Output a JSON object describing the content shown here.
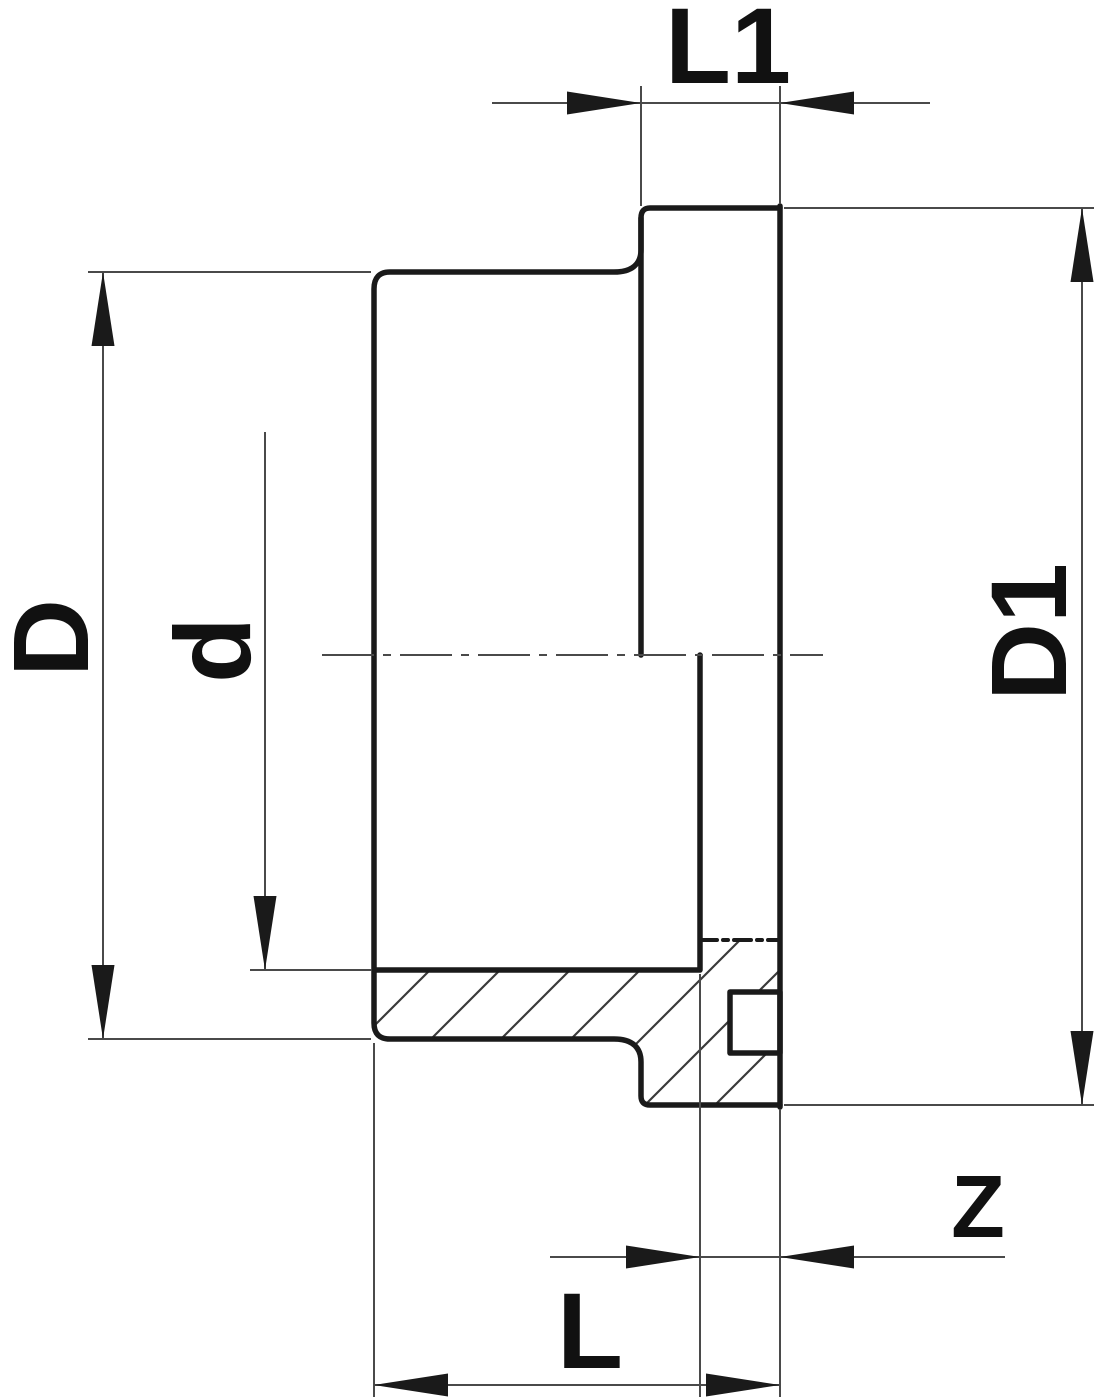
{
  "drawing": {
    "type": "technical-dimension-drawing",
    "subject": "flange-adaptor-cross-section",
    "background_color": "#ffffff",
    "outline_color": "#1a1a1a",
    "dimension_line_color": "#4a4a4a",
    "hatch_color": "#3a3a3a",
    "labels": {
      "flange_length": "L1",
      "outer_diameter": "D",
      "bore_diameter": "d",
      "flange_diameter": "D1",
      "z_dimension": "Z",
      "overall_length": "L"
    },
    "dimensions": [
      {
        "id": "L1",
        "label": "L1",
        "orientation": "horizontal",
        "measures": "flange width (top)"
      },
      {
        "id": "D",
        "label": "D",
        "orientation": "vertical",
        "measures": "body outer diameter (left)"
      },
      {
        "id": "d",
        "label": "d",
        "orientation": "vertical",
        "measures": "bore diameter (left inner)"
      },
      {
        "id": "D1",
        "label": "D1",
        "orientation": "vertical",
        "measures": "flange outer diameter (right)"
      },
      {
        "id": "Z",
        "label": "Z",
        "orientation": "horizontal",
        "measures": "insertion depth (bottom right)"
      },
      {
        "id": "L",
        "label": "L",
        "orientation": "horizontal",
        "measures": "overall length (bottom)"
      }
    ]
  }
}
